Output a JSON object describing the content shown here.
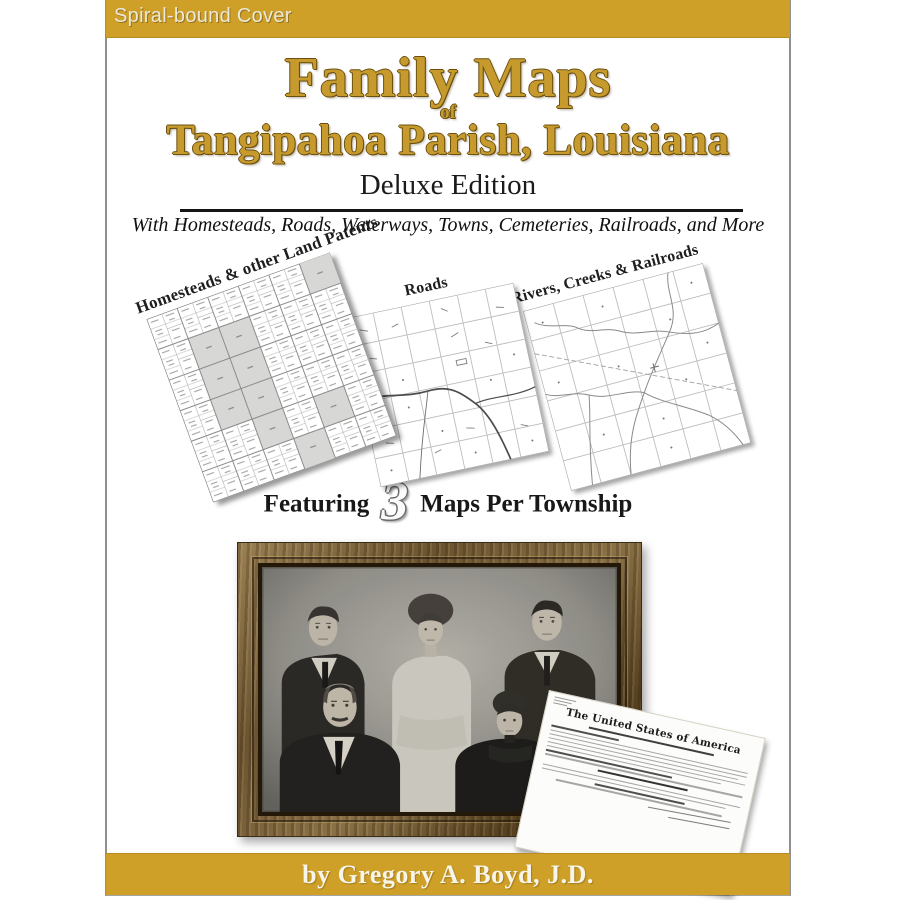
{
  "cover": {
    "binding_label": "Spiral-bound Cover",
    "author_line": "by Gregory A. Boyd, J.D."
  },
  "title": {
    "main": "Family Maps",
    "connector": "of",
    "region": "Tangipahoa Parish, Louisiana",
    "edition": "Deluxe Edition",
    "tagline": "With Homesteads, Roads, Waterways, Towns, Cemeteries, Railroads, and More"
  },
  "maps": [
    {
      "label": "Homesteads & other Land Patents"
    },
    {
      "label": "Roads"
    },
    {
      "label": "Rivers, Creeks & Railroads"
    }
  ],
  "featuring": {
    "prefix": "Featuring",
    "count": "3",
    "suffix": "Maps Per Township"
  },
  "document_preview": {
    "heading": "The United States of America"
  },
  "colors": {
    "banner_gold": "#CFA028",
    "title_gold": "#C69A2D",
    "title_outline": "#6B500F"
  }
}
